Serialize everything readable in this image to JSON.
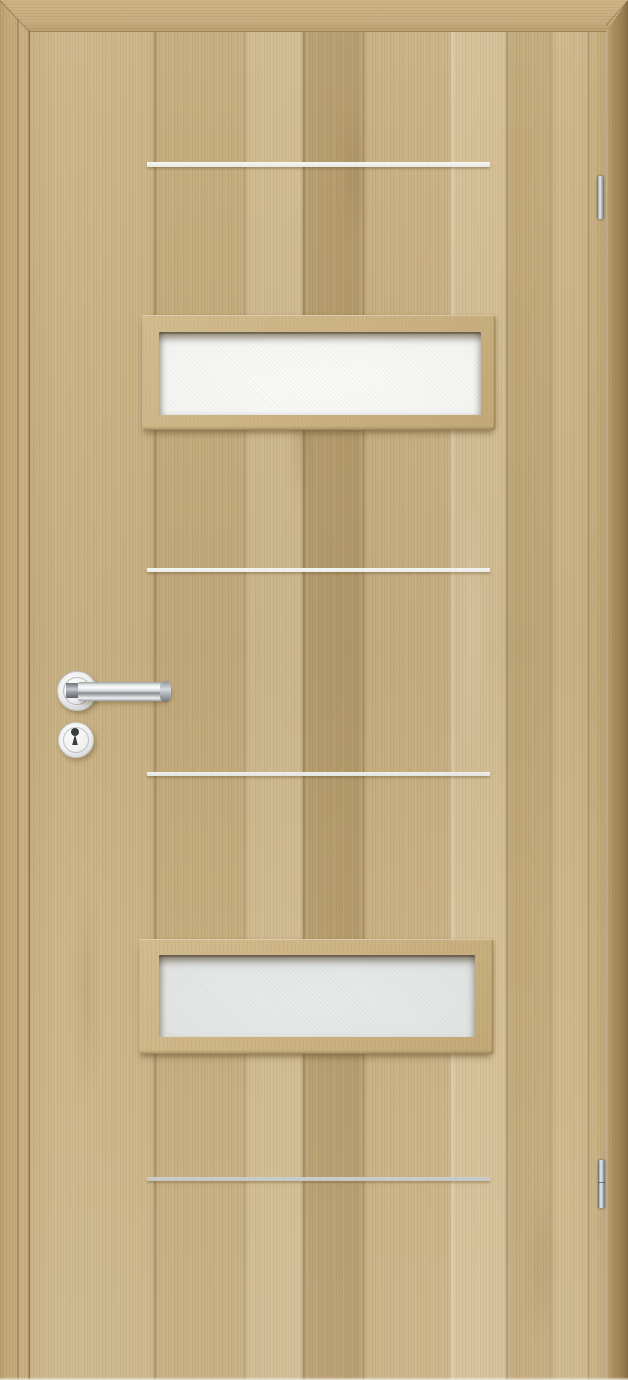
{
  "scene": {
    "type": "product-photo",
    "subject": "Interior door leaf, light oak woodgrain finish",
    "visible_elements": [
      "planked oak-effect door surface with mitered edge banding on top, left and right",
      "four horizontal aluminium inlay strips",
      "upper rectangular frosted-glass panel in wooden frame",
      "lower rectangular frosted-glass panel in wooden frame",
      "chrome lever handle on round rose",
      "round keyhole escutcheon with dark keyhole",
      "two chrome hinge pins on right edge"
    ]
  },
  "door": {
    "colors": {
      "wood_base": "#c9b184",
      "wood_light": "#d6c197",
      "wood_dark": "#b49b6c",
      "wood_edge": "#9d8354",
      "grain_line": "#8a7347",
      "glass_upper": "#f5f6f4",
      "glass_lower": "#e4e6e5",
      "strip_bright": "#f6f6f3",
      "strip_soft": "#ecece8",
      "strip_silver": "#c4c6c4",
      "chrome_light": "#f0f2f3",
      "chrome_dark": "#787e84",
      "keyhole_dark": "#3a3d3f"
    },
    "hardware": {
      "glass_panel_count": 2,
      "inlay_strip_count": 4,
      "hinge_count": 2
    }
  }
}
